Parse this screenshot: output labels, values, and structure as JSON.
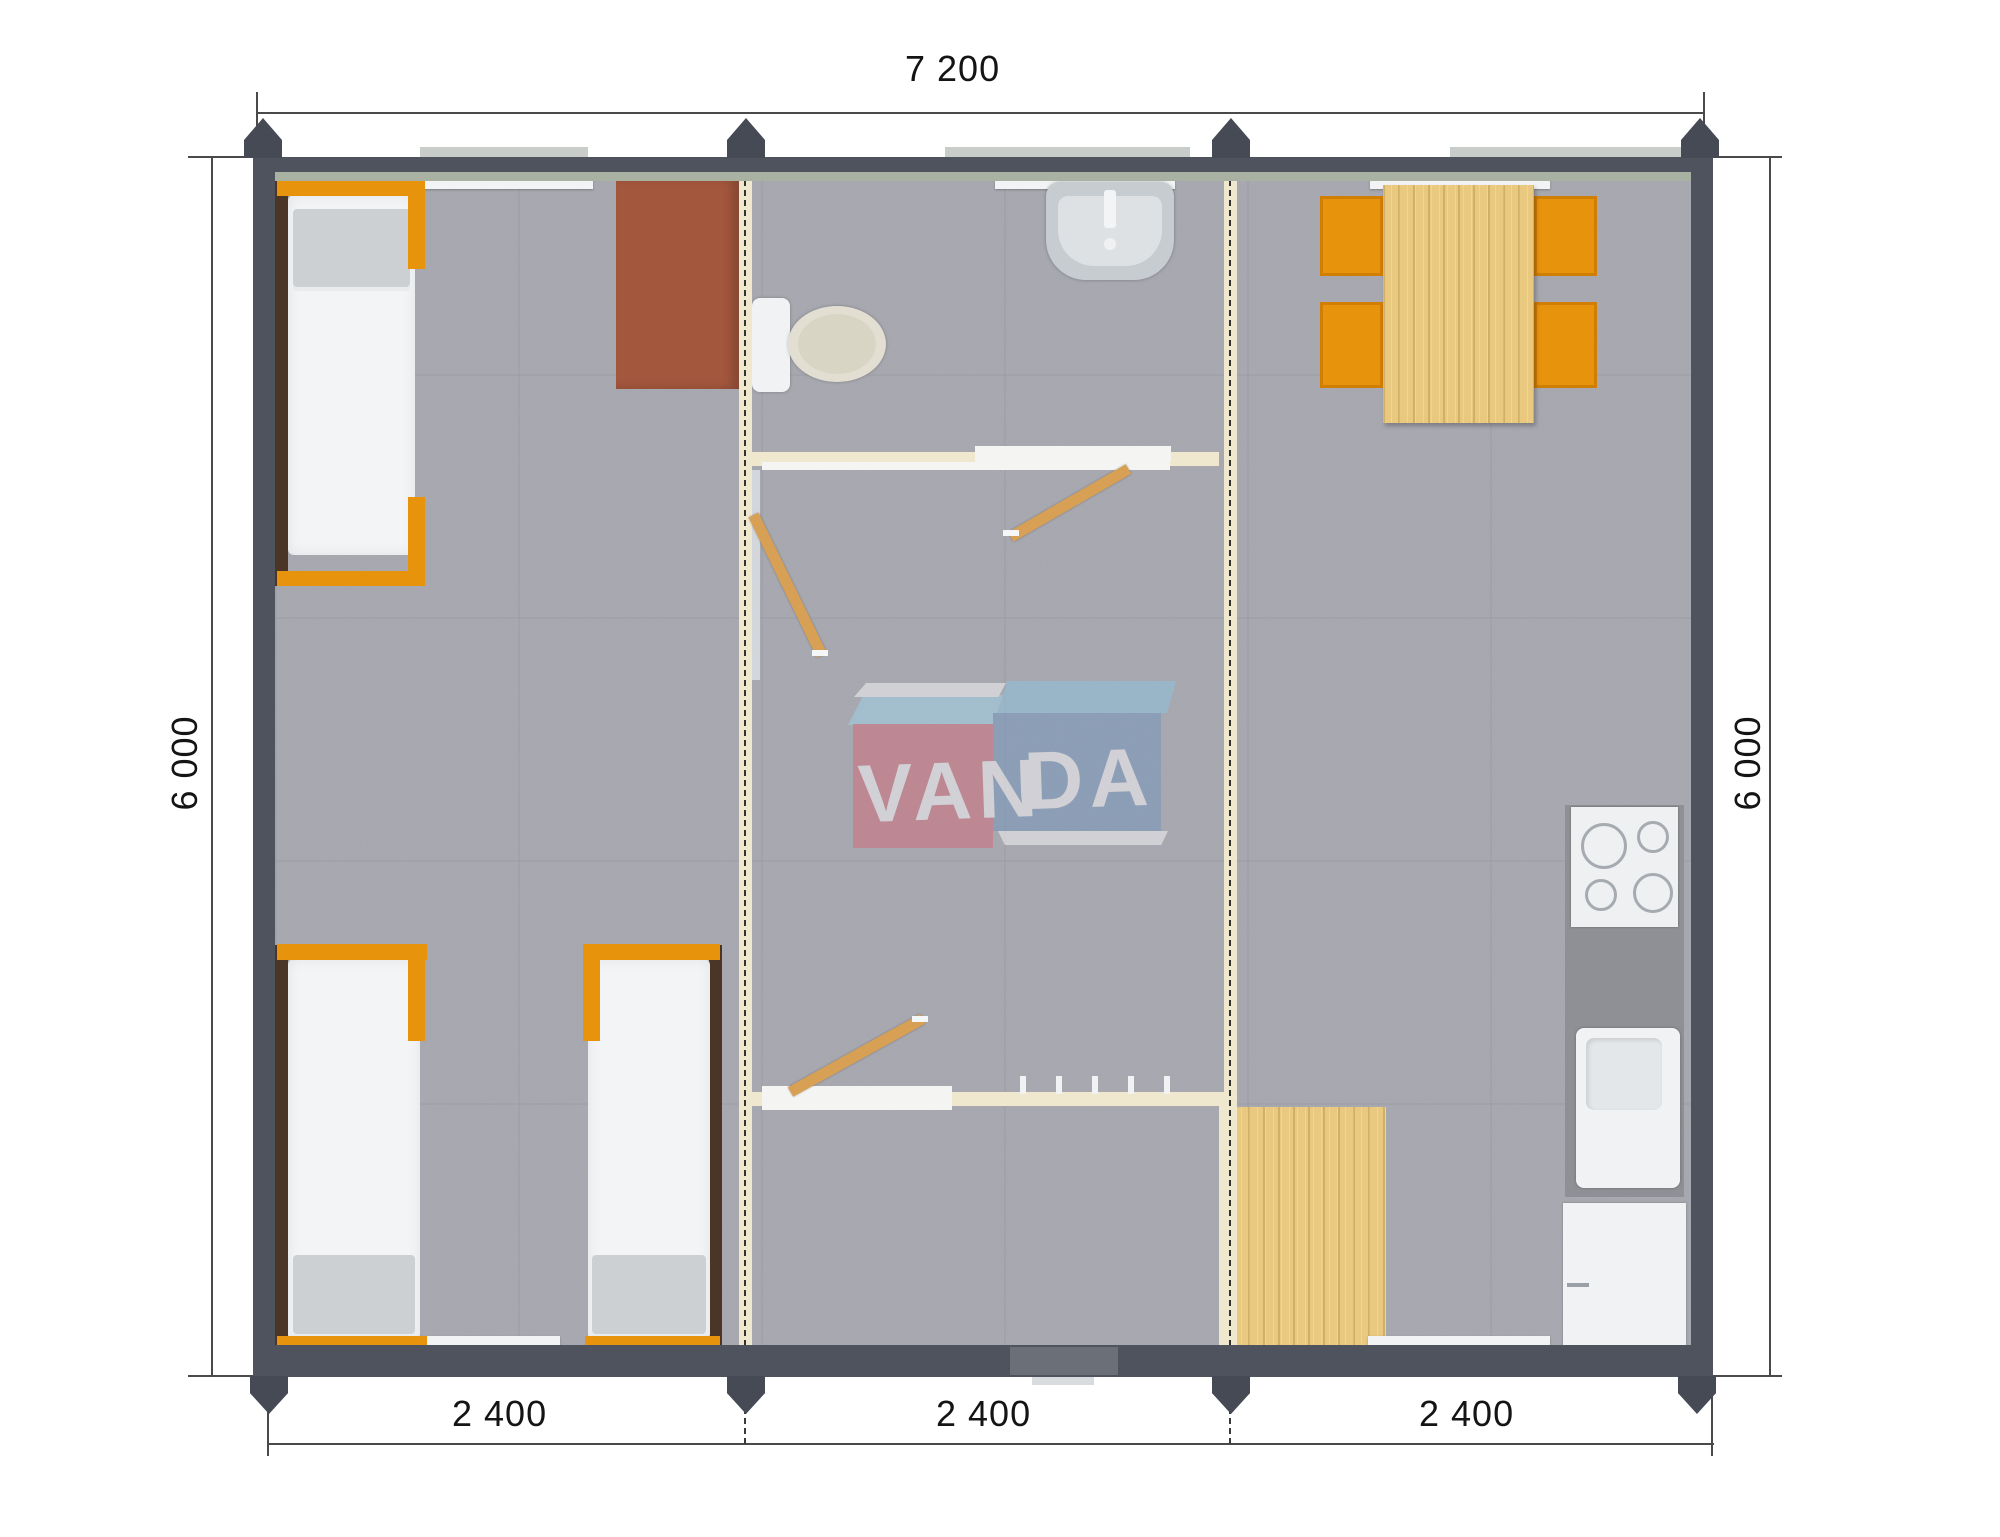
{
  "dimensions": {
    "top_total": "7 200",
    "left_height": "6 000",
    "right_height": "6 000",
    "modules": {
      "m1": "2 400",
      "m2": "2 400",
      "m3": "2 400"
    }
  },
  "watermark": {
    "left": "VAN",
    "right": "DA"
  },
  "colors": {
    "wall": "#4e535d",
    "carpet": "#a8a8b0",
    "partition_cream": "#efe8ce",
    "wood_door": "#d8a055",
    "wood_floor": "#e9c87f",
    "accent_orange": "#e8930c",
    "desk_brown": "#a3573d",
    "counter_gray": "#8e9095",
    "fixture_white": "#f0f2f4",
    "logo_red": "#cf6f7c",
    "logo_blue": "#7796bd",
    "logo_light_blue": "#9fd0e6"
  },
  "furniture_icons": [
    "bed",
    "desk",
    "toilet",
    "wash-basin",
    "door-leaf",
    "dining-table",
    "chair",
    "cooktop",
    "kitchen-sink",
    "fridge",
    "wood-mat",
    "coat-hooks"
  ]
}
